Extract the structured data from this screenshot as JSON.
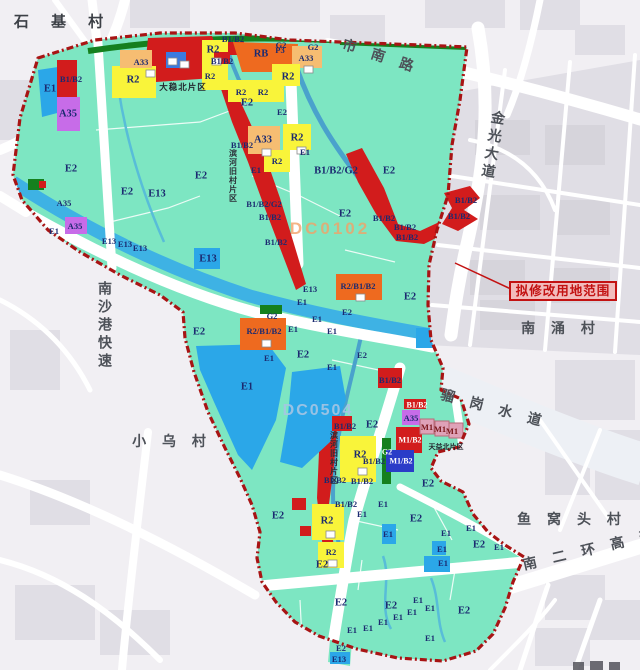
{
  "map": {
    "callout": {
      "text": "拟修改用地范围"
    },
    "colors": {
      "planning_area": "#7de6c2",
      "boundary": "#a81414",
      "water_blue": "#2ba7e8",
      "residential_R2": "#f9f43a",
      "public_A33": "#f6bd72",
      "commercial_B1B2": "#d21c1c",
      "mixed_RB": "#ee6a1f",
      "culture_A35": "#c76ce8",
      "industry_M1": "#dfa2b8",
      "industry_M1B2": "#2a3cc8",
      "green_G2": "#15801e",
      "background": "#f1eff3",
      "callout_red": "#c31212"
    },
    "labels": [
      {
        "t": "石 基 村",
        "k": "place-lg",
        "x": 63,
        "y": 21
      },
      {
        "t": "市 南 路",
        "k": "place",
        "x": 381,
        "y": 56,
        "r": 18
      },
      {
        "t": "金光大道",
        "k": "pv",
        "x": 493,
        "y": 146,
        "r": 10
      },
      {
        "t": "南 涌 村",
        "k": "place",
        "x": 561,
        "y": 328
      },
      {
        "t": "骝 岗 水 道",
        "k": "place",
        "x": 494,
        "y": 408,
        "r": 15
      },
      {
        "t": "鱼 窝 头 村",
        "k": "place",
        "x": 572,
        "y": 519
      },
      {
        "t": "南 二 环 高 速",
        "k": "place",
        "x": 591,
        "y": 549,
        "r": -13
      },
      {
        "t": "南沙港快速",
        "k": "pv",
        "x": 105,
        "y": 326
      },
      {
        "t": "小 乌 村",
        "k": "place",
        "x": 172,
        "y": 441
      },
      {
        "t": "大稳北片区",
        "k": "dist",
        "x": 183,
        "y": 87
      },
      {
        "t": "滨河旧村片区",
        "k": "dv",
        "x": 233,
        "y": 176
      },
      {
        "t": "滨河旧村片区",
        "k": "dv",
        "x": 334,
        "y": 458
      },
      {
        "t": "天益北片区",
        "k": "dist-s",
        "x": 446,
        "y": 447
      },
      {
        "t": "DC0102",
        "k": "wmo",
        "x": 330,
        "y": 229
      },
      {
        "t": "DC0504",
        "k": "wmb",
        "x": 318,
        "y": 411
      },
      {
        "t": "E1",
        "x": 50,
        "y": 89
      },
      {
        "t": "B1/B2",
        "k": "zs",
        "x": 71,
        "y": 79
      },
      {
        "t": "A35",
        "x": 68,
        "y": 114
      },
      {
        "t": "E2",
        "x": 71,
        "y": 169
      },
      {
        "t": "R2",
        "x": 133,
        "y": 80
      },
      {
        "t": "A33",
        "k": "zs",
        "x": 141,
        "y": 62
      },
      {
        "t": "R2",
        "x": 213,
        "y": 50
      },
      {
        "t": "R2",
        "k": "zs",
        "x": 210,
        "y": 76
      },
      {
        "t": "B1/B2",
        "k": "zs",
        "x": 233,
        "y": 39
      },
      {
        "t": "G2",
        "k": "zs",
        "x": 281,
        "y": 45
      },
      {
        "t": "G2",
        "k": "zs",
        "x": 313,
        "y": 47
      },
      {
        "t": "RB",
        "x": 261,
        "y": 54
      },
      {
        "t": "P3",
        "k": "zs",
        "x": 280,
        "y": 50
      },
      {
        "t": "A33",
        "k": "zs",
        "x": 306,
        "y": 58
      },
      {
        "t": "R2",
        "x": 288,
        "y": 77
      },
      {
        "t": "B1/B2",
        "k": "zs",
        "x": 222,
        "y": 61
      },
      {
        "t": "E2",
        "x": 247,
        "y": 103
      },
      {
        "t": "R2",
        "k": "zs",
        "x": 241,
        "y": 92
      },
      {
        "t": "R2",
        "k": "zs",
        "x": 263,
        "y": 92
      },
      {
        "t": "A33",
        "x": 263,
        "y": 140
      },
      {
        "t": "R2",
        "x": 297,
        "y": 138
      },
      {
        "t": "R2",
        "k": "zs",
        "x": 277,
        "y": 161
      },
      {
        "t": "E2",
        "k": "zs",
        "x": 282,
        "y": 112
      },
      {
        "t": "E2",
        "x": 201,
        "y": 176
      },
      {
        "t": "E1",
        "k": "zs",
        "x": 256,
        "y": 170
      },
      {
        "t": "E1",
        "k": "zs",
        "x": 305,
        "y": 152
      },
      {
        "t": "B1/B2",
        "k": "zs",
        "x": 242,
        "y": 145
      },
      {
        "t": "E2",
        "x": 127,
        "y": 192
      },
      {
        "t": "E13",
        "x": 157,
        "y": 194
      },
      {
        "t": "A35",
        "k": "zs",
        "x": 64,
        "y": 203
      },
      {
        "t": "A35",
        "k": "zs",
        "x": 75,
        "y": 226
      },
      {
        "t": "E1",
        "k": "zs",
        "x": 54,
        "y": 231
      },
      {
        "t": "E13",
        "k": "zs",
        "x": 109,
        "y": 241
      },
      {
        "t": "E13",
        "k": "zs",
        "x": 125,
        "y": 244
      },
      {
        "t": "E13",
        "k": "zs",
        "x": 140,
        "y": 248
      },
      {
        "t": "E13",
        "x": 208,
        "y": 259
      },
      {
        "t": "E2",
        "x": 345,
        "y": 214
      },
      {
        "t": "B1/B2/G2",
        "k": "zs",
        "x": 264,
        "y": 204
      },
      {
        "t": "B1/B2",
        "k": "zs",
        "x": 270,
        "y": 217
      },
      {
        "t": "B1/B2",
        "k": "zs",
        "x": 276,
        "y": 242
      },
      {
        "t": "B1/B2/G2",
        "x": 336,
        "y": 171
      },
      {
        "t": "E2",
        "x": 389,
        "y": 171
      },
      {
        "t": "B1/B2",
        "k": "zs",
        "x": 384,
        "y": 218
      },
      {
        "t": "B1/B2",
        "k": "zs",
        "x": 405,
        "y": 227
      },
      {
        "t": "B1/B2",
        "k": "zs",
        "x": 407,
        "y": 237
      },
      {
        "t": "B1/B2",
        "k": "zs",
        "x": 459,
        "y": 216
      },
      {
        "t": "B1/B2",
        "k": "zs",
        "x": 466,
        "y": 200
      },
      {
        "t": "E13",
        "k": "zs",
        "x": 310,
        "y": 289
      },
      {
        "t": "E1",
        "k": "zs",
        "x": 302,
        "y": 302
      },
      {
        "t": "G2",
        "k": "zs",
        "x": 272,
        "y": 316
      },
      {
        "t": "R2/B1/B2",
        "k": "zs",
        "x": 358,
        "y": 286
      },
      {
        "t": "E2",
        "x": 410,
        "y": 297
      },
      {
        "t": "E2",
        "k": "zs",
        "x": 347,
        "y": 312
      },
      {
        "t": "E1",
        "k": "zs",
        "x": 317,
        "y": 319
      },
      {
        "t": "E2",
        "x": 199,
        "y": 332
      },
      {
        "t": "R2/B1/B2",
        "k": "zs",
        "x": 264,
        "y": 331
      },
      {
        "t": "E1",
        "k": "zs",
        "x": 293,
        "y": 329
      },
      {
        "t": "E1",
        "k": "zs",
        "x": 332,
        "y": 331
      },
      {
        "t": "E2",
        "x": 303,
        "y": 355
      },
      {
        "t": "E1",
        "k": "zs",
        "x": 269,
        "y": 358
      },
      {
        "t": "E2",
        "k": "zs",
        "x": 362,
        "y": 355
      },
      {
        "t": "E1",
        "k": "zs",
        "x": 332,
        "y": 367
      },
      {
        "t": "E1",
        "x": 247,
        "y": 387
      },
      {
        "t": "B1/B2",
        "k": "zs",
        "x": 390,
        "y": 380
      },
      {
        "t": "B1/B2",
        "k": "zs",
        "x": 345,
        "y": 426
      },
      {
        "t": "E2",
        "x": 372,
        "y": 425
      },
      {
        "t": "B1/B2",
        "k": "zw",
        "x": 417,
        "y": 405
      },
      {
        "t": "A35",
        "k": "zs",
        "x": 411,
        "y": 418
      },
      {
        "t": "M1",
        "k": "m1",
        "x": 427,
        "y": 427
      },
      {
        "t": "M1",
        "k": "m1",
        "x": 440,
        "y": 429
      },
      {
        "t": "M1",
        "k": "m1",
        "x": 452,
        "y": 431
      },
      {
        "t": "M1/B2",
        "k": "zw",
        "x": 410,
        "y": 440
      },
      {
        "t": "G2",
        "k": "zw",
        "x": 387,
        "y": 452
      },
      {
        "t": "R2",
        "x": 360,
        "y": 455
      },
      {
        "t": "B1/B2",
        "k": "zs",
        "x": 374,
        "y": 461
      },
      {
        "t": "M1/B2",
        "k": "zw",
        "x": 401,
        "y": 461
      },
      {
        "t": "B1/B2",
        "k": "zs",
        "x": 335,
        "y": 480
      },
      {
        "t": "B1/B2",
        "k": "zs",
        "x": 362,
        "y": 481
      },
      {
        "t": "E2",
        "x": 428,
        "y": 484
      },
      {
        "t": "B1/B2",
        "k": "zs",
        "x": 346,
        "y": 504
      },
      {
        "t": "R2",
        "x": 327,
        "y": 521
      },
      {
        "t": "E2",
        "x": 278,
        "y": 516
      },
      {
        "t": "E1",
        "k": "zs",
        "x": 362,
        "y": 514
      },
      {
        "t": "E1",
        "k": "zs",
        "x": 383,
        "y": 504
      },
      {
        "t": "E1",
        "k": "zs",
        "x": 388,
        "y": 534
      },
      {
        "t": "E2",
        "x": 416,
        "y": 519
      },
      {
        "t": "E1",
        "k": "zs",
        "x": 446,
        "y": 533
      },
      {
        "t": "E1",
        "k": "zs",
        "x": 471,
        "y": 528
      },
      {
        "t": "E2",
        "x": 479,
        "y": 545
      },
      {
        "t": "E1",
        "k": "zs",
        "x": 499,
        "y": 547
      },
      {
        "t": "E1",
        "k": "zs",
        "x": 442,
        "y": 549
      },
      {
        "t": "E1",
        "k": "zs",
        "x": 443,
        "y": 563
      },
      {
        "t": "R2",
        "k": "zs",
        "x": 331,
        "y": 552
      },
      {
        "t": "E2",
        "x": 322,
        "y": 565
      },
      {
        "t": "E2",
        "x": 341,
        "y": 603
      },
      {
        "t": "E2",
        "x": 391,
        "y": 606
      },
      {
        "t": "E2",
        "x": 464,
        "y": 611
      },
      {
        "t": "E1",
        "k": "zs",
        "x": 418,
        "y": 600
      },
      {
        "t": "E1",
        "k": "zs",
        "x": 412,
        "y": 612
      },
      {
        "t": "E1",
        "k": "zs",
        "x": 430,
        "y": 608
      },
      {
        "t": "E1",
        "k": "zs",
        "x": 398,
        "y": 617
      },
      {
        "t": "E1",
        "k": "zs",
        "x": 383,
        "y": 622
      },
      {
        "t": "E1",
        "k": "zs",
        "x": 368,
        "y": 628
      },
      {
        "t": "E1",
        "k": "zs",
        "x": 352,
        "y": 630
      },
      {
        "t": "E1",
        "k": "zs",
        "x": 430,
        "y": 638
      },
      {
        "t": "E2",
        "k": "zs",
        "x": 341,
        "y": 648
      },
      {
        "t": "E13",
        "k": "zs",
        "x": 339,
        "y": 659
      }
    ]
  }
}
